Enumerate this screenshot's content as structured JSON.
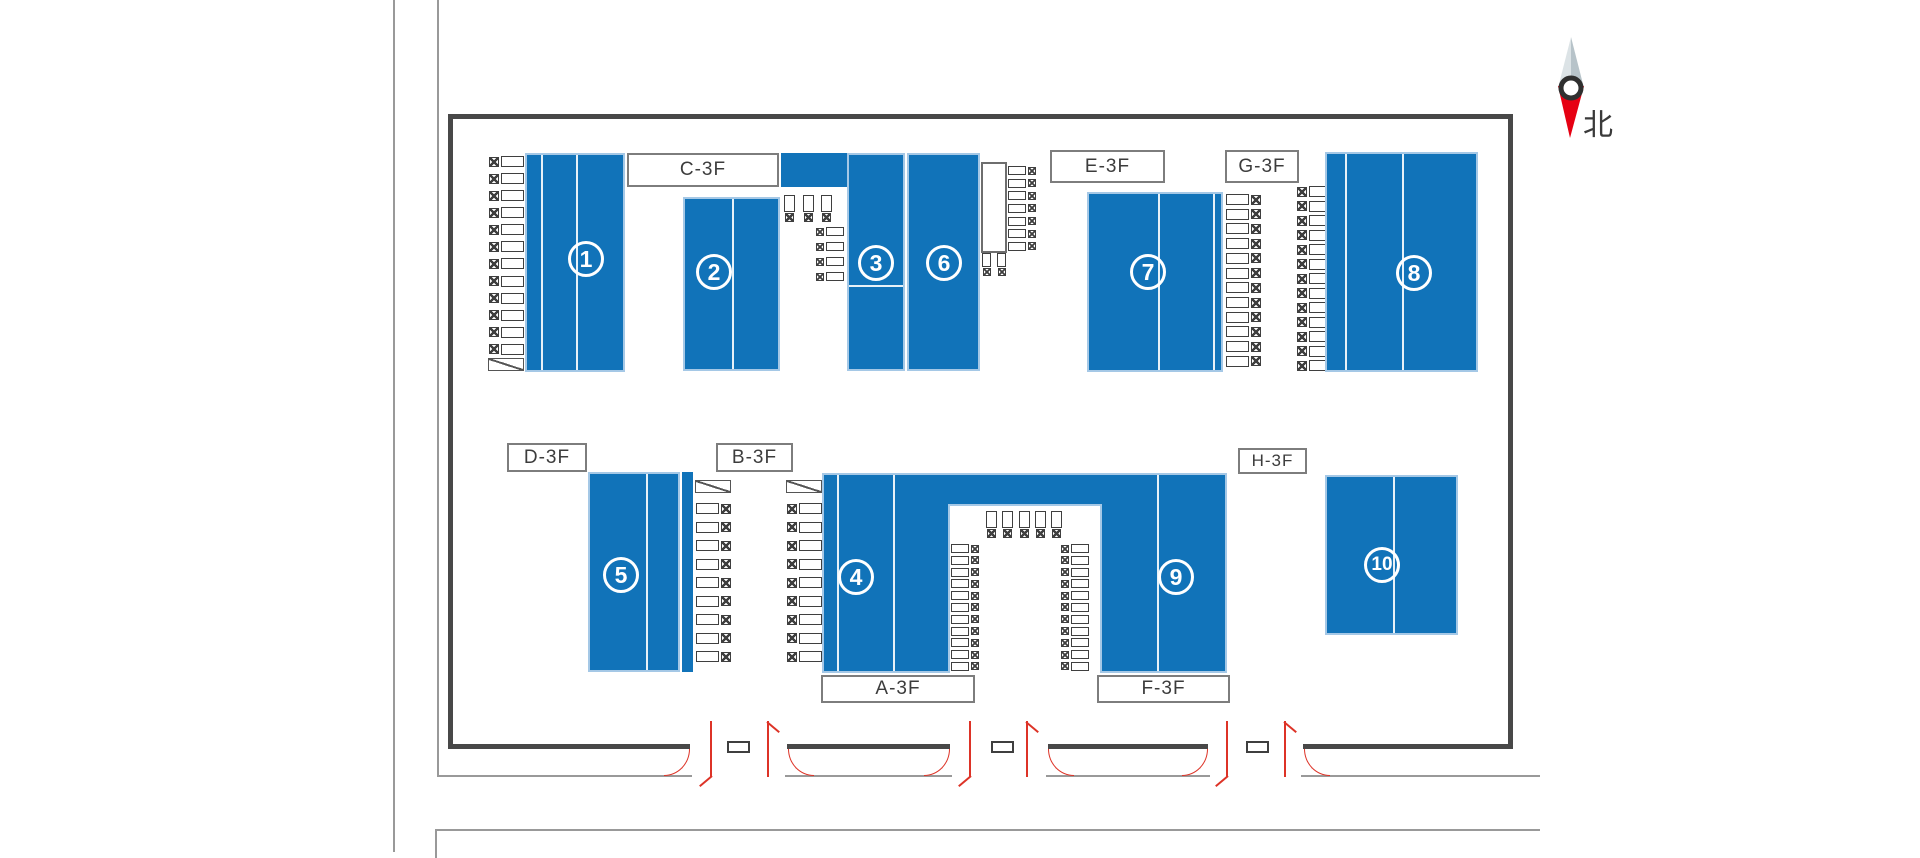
{
  "compass": {
    "north_label": "北"
  },
  "areas": {
    "c": "C-3F",
    "e": "E-3F",
    "g": "G-3F",
    "d": "D-3F",
    "b": "B-3F",
    "h": "H-3F",
    "a": "A-3F",
    "f": "F-3F"
  },
  "blocks": {
    "n1": "1",
    "n2": "2",
    "n3": "3",
    "n4": "4",
    "n5": "5",
    "n6": "6",
    "n7": "7",
    "n8": "8",
    "n9": "9",
    "n10": "10"
  },
  "colors": {
    "block_blue": "#1173b9",
    "block_border": "#a5c8e6",
    "block_divider": "#ffffff",
    "wall": "#484848",
    "site_line": "#999999",
    "door_red": "#dd3327",
    "compass_red": "#e60012",
    "compass_gray": "#b7c3c9",
    "icon_line": "#3f3f3f",
    "label_border": "#7d7d7d",
    "text": "#3c3c3c"
  }
}
